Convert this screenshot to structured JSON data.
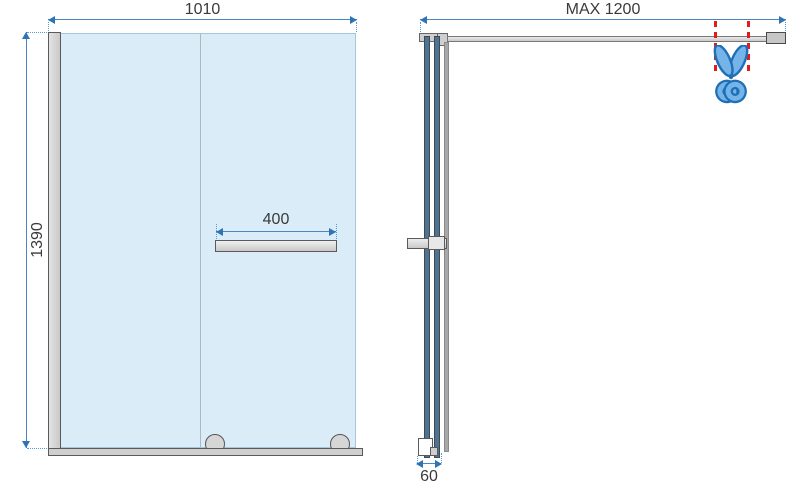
{
  "dimensions": {
    "front_width": "1010",
    "front_height": "1390",
    "shelf_width": "400",
    "arm_max_length": "MAX 1200",
    "profile_depth": "60"
  },
  "icons": {
    "scissors": "✂"
  },
  "colors": {
    "glass_fill": "#d9ecf8",
    "dimension_blue": "#2e74b5",
    "cut_line_red": "#e01c1c",
    "scissors_fill": "#74b4e8",
    "scissors_outline": "#1f6fb5",
    "frame_gray": "#cfcfcf",
    "glass_edge_steel": "#4f7390"
  }
}
